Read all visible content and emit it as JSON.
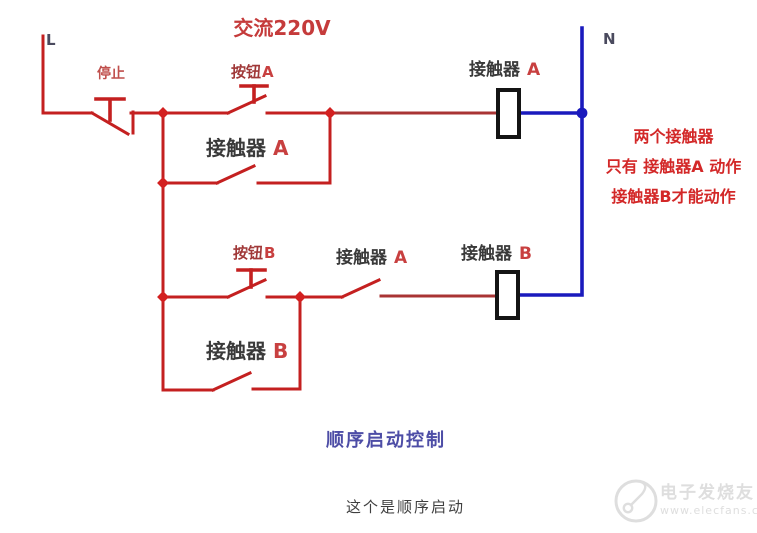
{
  "diagram": {
    "voltage_label": "交流220V",
    "terminal_l": "L",
    "terminal_n": "N",
    "stop_button": "停止",
    "button_a": {
      "name": "按钮",
      "tag": "A"
    },
    "button_b": {
      "name": "按钮",
      "tag": "B"
    },
    "holding_contact_a": {
      "name": "接触器",
      "tag": "A"
    },
    "coil_a": {
      "name": "接触器",
      "tag": "A"
    },
    "interlock_contact_a": {
      "name": "接触器",
      "tag": "A"
    },
    "coil_b": {
      "name": "接触器",
      "tag": "B"
    },
    "holding_contact_b": {
      "name": "接触器",
      "tag": "B"
    },
    "annotation": {
      "line1": "两个接触器",
      "line2": "只有 接触器A 动作",
      "line3": "接触器B才能动作"
    },
    "caption": "顺序启动控制"
  },
  "page_caption": "这个是顺序启动",
  "watermark": {
    "brand": "电子发烧友",
    "url": "www.elecfans.com"
  },
  "colors": {
    "wire_red": "#c42020",
    "wire_red_dark": "#a93434",
    "wire_blue": "#1a1abd",
    "coil_stroke": "#141414",
    "junction_red": "#d32020",
    "label_dark": "#3a3a3a",
    "label_red": "#c84040",
    "button_label_red": "#a03838",
    "stop_label_red": "#c0504d",
    "voltage_red": "#c53b3b",
    "annotation_red": "#d32828",
    "caption_blue": "#4d4da6",
    "caption_dark": "#3f3f3f",
    "terminal_color": "#4a4a5e",
    "watermark_gray": "#dedede"
  }
}
